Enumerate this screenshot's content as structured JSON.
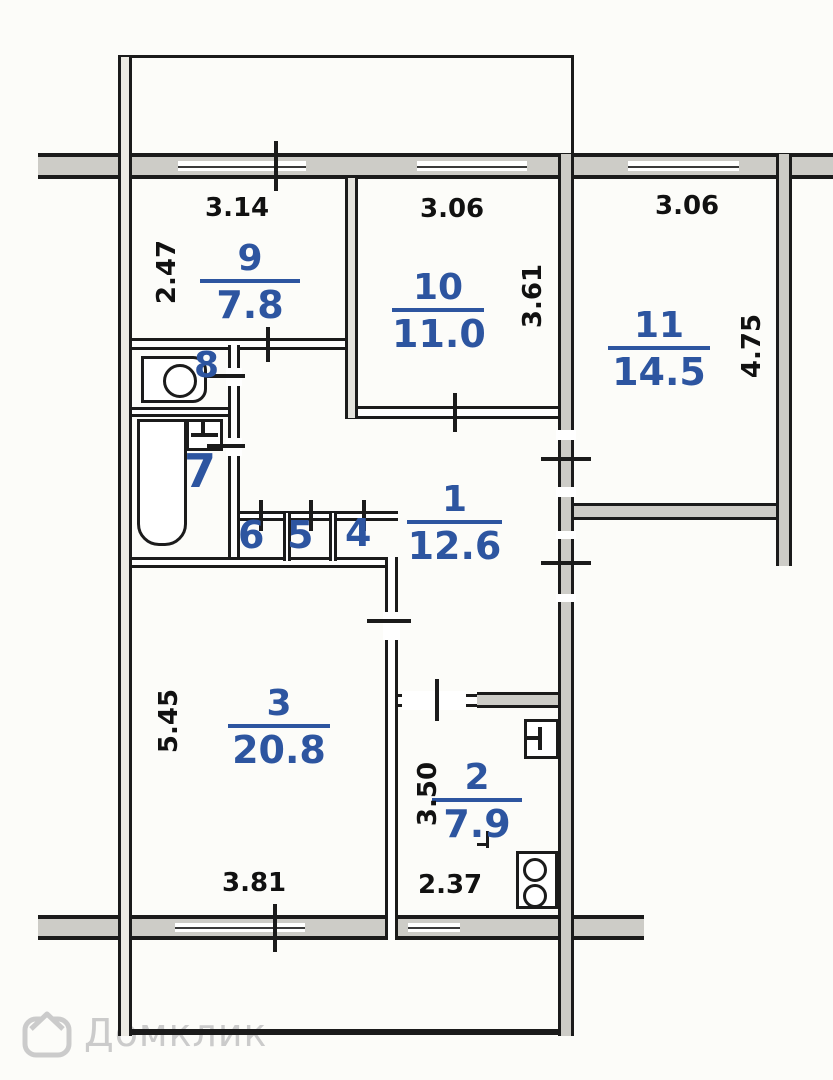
{
  "rooms": {
    "r1": {
      "number": "1",
      "area": "12.6"
    },
    "r2": {
      "number": "2",
      "area": "7.9"
    },
    "r3": {
      "number": "3",
      "area": "20.8"
    },
    "r9": {
      "number": "9",
      "area": "7.8"
    },
    "r10": {
      "number": "10",
      "area": "11.0"
    },
    "r11": {
      "number": "11",
      "area": "14.5"
    },
    "r4": {
      "number": "4"
    },
    "r5": {
      "number": "5"
    },
    "r6": {
      "number": "6"
    },
    "r7": {
      "number": "7"
    },
    "r8": {
      "number": "8"
    }
  },
  "dimensions": {
    "d9_top": "3.14",
    "d9_left": "2.47",
    "d10_top": "3.06",
    "d10_right": "3.61",
    "d11_top": "3.06",
    "d11_right": "4.75",
    "d3_left": "5.45",
    "d3_bottom": "3.81",
    "d2_left": "3.50",
    "d2_bottom": "2.37"
  },
  "watermark": {
    "text": "Домклик"
  },
  "colors": {
    "wall": "#1b1b1b",
    "wall_fill": "#cdccc7",
    "room_label_blue": "#2d55a0",
    "dimension_text": "#111111",
    "watermark_gray": "#cbcbcb",
    "background": "#fcfcf9"
  }
}
